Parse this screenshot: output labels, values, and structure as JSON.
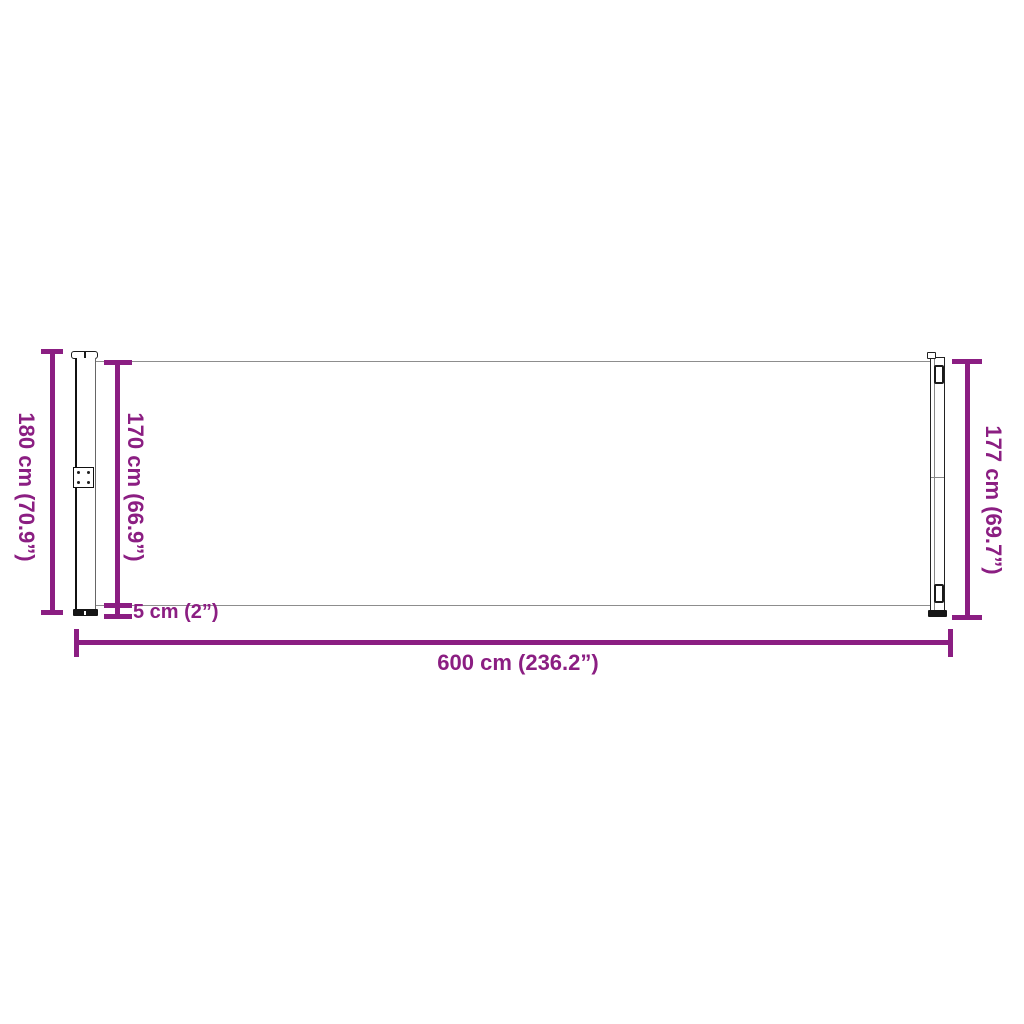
{
  "accent_color": "#8B1E82",
  "diagram": {
    "type": "product-dimension-diagram",
    "labels": {
      "total_height": "180 cm (70.9”)",
      "fabric_height": "170 cm (66.9”)",
      "right_height": "177 cm (69.7”)",
      "bottom_gap": "5 cm (2”)",
      "total_width": "600 cm (236.2”)"
    }
  }
}
